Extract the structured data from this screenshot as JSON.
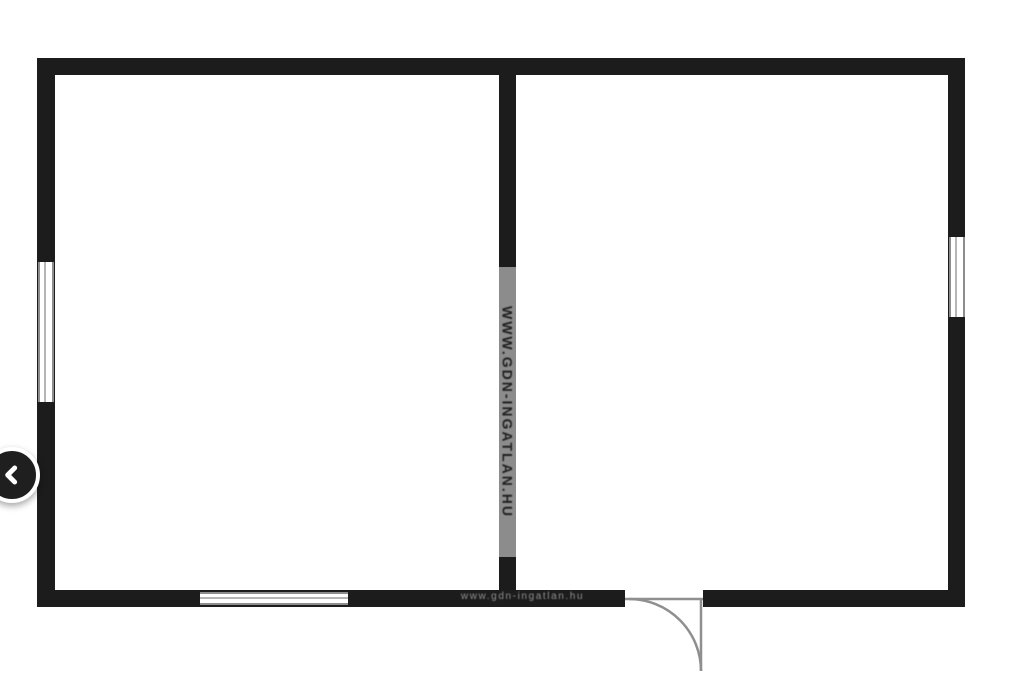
{
  "page": {
    "type": "floor-plan-image",
    "background": "#ffffff"
  },
  "colors": {
    "page_bg": "#ffffff",
    "wall": "#1c1c1c",
    "window_line": "#8d8d8d",
    "door_line": "#8f8f8f",
    "watermark_strip": "#8c8c8c",
    "watermark_text": "#1f1f1f",
    "bottom_watermark_text": "#909090",
    "nav_button_bg": "#1f1f1f",
    "nav_button_ring": "#ffffff",
    "chevron": "#ffffff"
  },
  "floorplan": {
    "layout": "two-room rectangular plan divided by one interior vertical wall",
    "watermark_vertical": "www.gdn-ingatlan.hu",
    "watermark_bottom": "www.gdn-ingatlan.hu",
    "walls": [
      "top",
      "bottom",
      "left",
      "right",
      "interior-vertical"
    ],
    "windows": [
      "left-wall-window",
      "right-wall-window",
      "bottom-wall-window"
    ],
    "doors": [
      "bottom-swing-door-right-room"
    ]
  },
  "nav": {
    "prev_button_icon": "chevron-left"
  }
}
